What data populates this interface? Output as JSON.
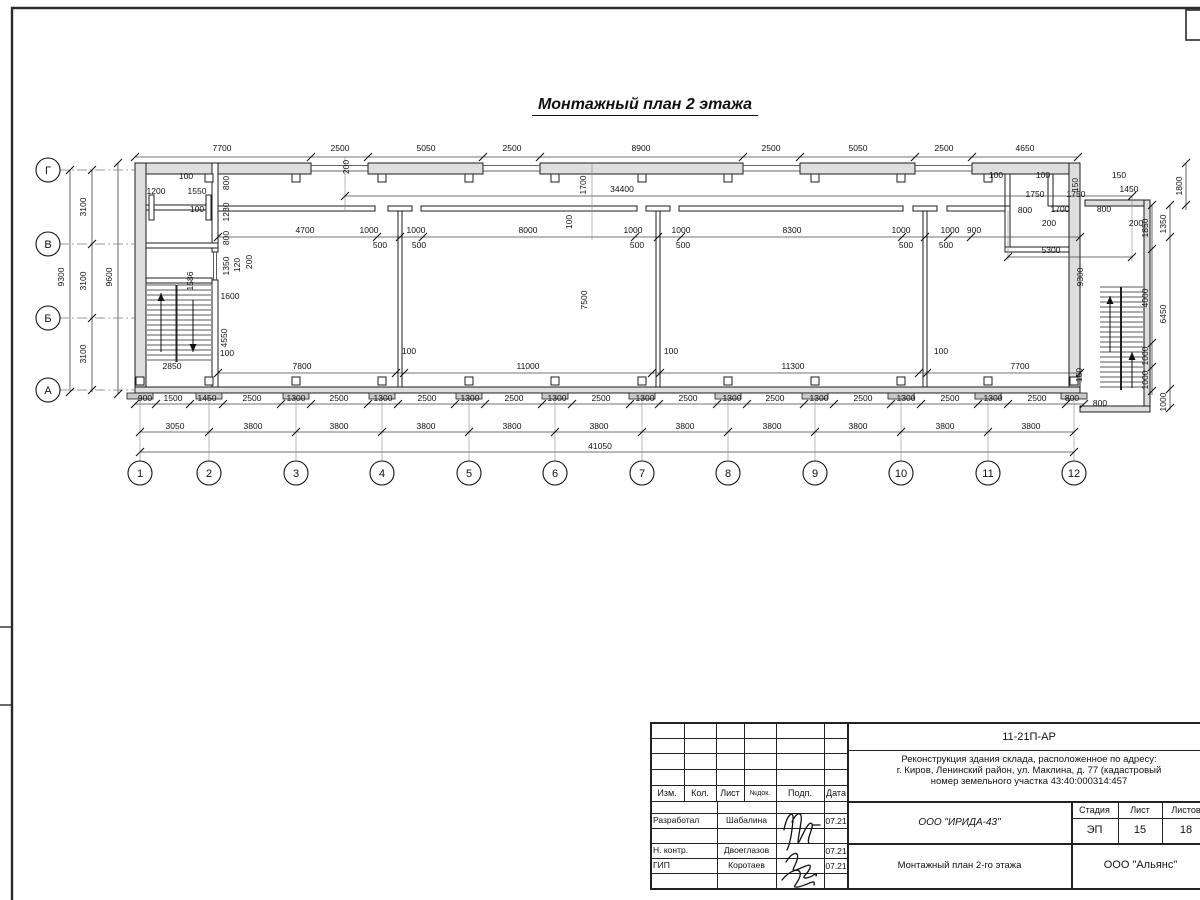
{
  "sheet": {
    "title": "Монтажный план 2 этажа"
  },
  "axes": {
    "rows": [
      {
        "label": "Г",
        "y": 170
      },
      {
        "label": "В",
        "y": 244
      },
      {
        "label": "Б",
        "y": 318
      },
      {
        "label": "А",
        "y": 390
      }
    ],
    "cols": [
      {
        "label": "1",
        "x": 140
      },
      {
        "label": "2",
        "x": 209
      },
      {
        "label": "3",
        "x": 296
      },
      {
        "label": "4",
        "x": 382
      },
      {
        "label": "5",
        "x": 469
      },
      {
        "label": "6",
        "x": 555
      },
      {
        "label": "7",
        "x": 642
      },
      {
        "label": "8",
        "x": 728
      },
      {
        "label": "9",
        "x": 815
      },
      {
        "label": "10",
        "x": 901
      },
      {
        "label": "11",
        "x": 988
      },
      {
        "label": "12",
        "x": 1074
      }
    ]
  },
  "dim_labels": [
    [
      "7700",
      222,
      151
    ],
    [
      "2500",
      340,
      151
    ],
    [
      "5050",
      426,
      151
    ],
    [
      "2500",
      512,
      151
    ],
    [
      "8900",
      641,
      151
    ],
    [
      "2500",
      771,
      151
    ],
    [
      "5050",
      858,
      151
    ],
    [
      "2500",
      944,
      151
    ],
    [
      "4650",
      1025,
      151
    ],
    [
      "200",
      349,
      167,
      1
    ],
    [
      "34400",
      622,
      192
    ],
    [
      "1700",
      586,
      185,
      1
    ],
    [
      "100",
      572,
      222,
      1
    ],
    [
      "9300",
      64,
      277,
      1
    ],
    [
      "3100",
      86,
      207,
      1
    ],
    [
      "3100",
      86,
      281,
      1
    ],
    [
      "3100",
      86,
      354,
      1
    ],
    [
      "9600",
      112,
      277,
      1
    ],
    [
      "100",
      186,
      179
    ],
    [
      "1200",
      156,
      194
    ],
    [
      "1550",
      197,
      194
    ],
    [
      "100",
      197,
      212
    ],
    [
      "800",
      229,
      183,
      1
    ],
    [
      "1280",
      229,
      212,
      1
    ],
    [
      "800",
      229,
      238,
      1
    ],
    [
      "1350",
      229,
      266,
      1
    ],
    [
      "120",
      240,
      265,
      1
    ],
    [
      "200",
      252,
      262,
      1
    ],
    [
      "1586",
      193,
      281,
      1
    ],
    [
      "1600",
      230,
      299
    ],
    [
      "4550",
      227,
      338,
      1
    ],
    [
      "100",
      227,
      356
    ],
    [
      "2850",
      172,
      369
    ],
    [
      "4700",
      305,
      233
    ],
    [
      "1000",
      369,
      233
    ],
    [
      "1000",
      416,
      233
    ],
    [
      "500",
      380,
      248
    ],
    [
      "500",
      419,
      248
    ],
    [
      "8000",
      528,
      233
    ],
    [
      "1000",
      633,
      233
    ],
    [
      "1000",
      681,
      233
    ],
    [
      "500",
      637,
      248
    ],
    [
      "500",
      683,
      248
    ],
    [
      "8300",
      792,
      233
    ],
    [
      "1000",
      901,
      233
    ],
    [
      "1000",
      950,
      233
    ],
    [
      "900",
      974,
      233
    ],
    [
      "500",
      906,
      248
    ],
    [
      "500",
      946,
      248
    ],
    [
      "7500",
      587,
      300,
      1
    ],
    [
      "7800",
      302,
      369
    ],
    [
      "100",
      409,
      354
    ],
    [
      "11000",
      528,
      369
    ],
    [
      "100",
      671,
      354
    ],
    [
      "11300",
      793,
      369
    ],
    [
      "100",
      941,
      354
    ],
    [
      "7700",
      1020,
      369
    ],
    [
      "150",
      1082,
      375,
      1
    ],
    [
      "9300",
      1083,
      277,
      1
    ],
    [
      "5300",
      1051,
      253
    ],
    [
      "100",
      996,
      178
    ],
    [
      "100",
      1043,
      178
    ],
    [
      "150",
      1078,
      185,
      1
    ],
    [
      "150",
      1119,
      178
    ],
    [
      "1450",
      1129,
      192
    ],
    [
      "1750",
      1035,
      197
    ],
    [
      "1750",
      1076,
      197
    ],
    [
      "800",
      1025,
      213
    ],
    [
      "1700",
      1060,
      212
    ],
    [
      "800",
      1104,
      212
    ],
    [
      "200",
      1049,
      226
    ],
    [
      "200",
      1136,
      226
    ],
    [
      "1800",
      1182,
      186,
      1
    ],
    [
      "1850",
      1148,
      228,
      1
    ],
    [
      "1350",
      1166,
      224,
      1
    ],
    [
      "4000",
      1148,
      298,
      1
    ],
    [
      "6450",
      1166,
      314,
      1
    ],
    [
      "1000",
      1148,
      356,
      1
    ],
    [
      "1000",
      1148,
      380,
      1
    ],
    [
      "1000",
      1166,
      402,
      1
    ],
    [
      "800",
      1100,
      406
    ],
    [
      "900",
      145,
      401
    ],
    [
      "1500",
      173,
      401
    ],
    [
      "1450",
      207,
      401
    ],
    [
      "2500",
      252,
      401
    ],
    [
      "1300",
      296,
      401
    ],
    [
      "2500",
      339,
      401
    ],
    [
      "1300",
      383,
      401
    ],
    [
      "2500",
      427,
      401
    ],
    [
      "1300",
      470,
      401
    ],
    [
      "2500",
      514,
      401
    ],
    [
      "1300",
      557,
      401
    ],
    [
      "2500",
      601,
      401
    ],
    [
      "1300",
      645,
      401
    ],
    [
      "2500",
      688,
      401
    ],
    [
      "1300",
      732,
      401
    ],
    [
      "2500",
      775,
      401
    ],
    [
      "1300",
      819,
      401
    ],
    [
      "2500",
      863,
      401
    ],
    [
      "1300",
      906,
      401
    ],
    [
      "2500",
      950,
      401
    ],
    [
      "1300",
      993,
      401
    ],
    [
      "2500",
      1037,
      401
    ],
    [
      "800",
      1072,
      401
    ],
    [
      "3050",
      175,
      429
    ],
    [
      "3800",
      253,
      429
    ],
    [
      "3800",
      339,
      429
    ],
    [
      "3800",
      426,
      429
    ],
    [
      "3800",
      512,
      429
    ],
    [
      "3800",
      599,
      429
    ],
    [
      "3800",
      685,
      429
    ],
    [
      "3800",
      772,
      429
    ],
    [
      "3800",
      858,
      429
    ],
    [
      "3800",
      945,
      429
    ],
    [
      "3800",
      1031,
      429
    ],
    [
      "41050",
      600,
      449
    ]
  ],
  "titleblock": {
    "doc_number": "11-21П-АР",
    "description_lines": [
      "Реконструкция здания склада, расположенное по адресу:",
      "г. Киров, Ленинский район, ул. Маклина, д. 77 (кадастровый",
      "номер земельного участка 43:40:000314:457"
    ],
    "columns": {
      "izm": "Изм.",
      "kol": "Кол.",
      "list": "Лист",
      "ndok": "№док.",
      "podp": "Подп.",
      "data": "Дата"
    },
    "stage_label": "Стадия",
    "sheet_label": "Лист",
    "sheets_label": "Листов",
    "stage": "ЭП",
    "sheet_no": "15",
    "sheets_total": "18",
    "rows": [
      {
        "role": "Разработал",
        "name": "Шабалина",
        "date": "07.21"
      },
      {
        "role": "Н. контр.",
        "name": "Двоеглазов",
        "date": "07.21"
      },
      {
        "role": "ГИП",
        "name": "Коротаев",
        "date": "07.21"
      }
    ],
    "org": "ООО \"ИРИДА-43\"",
    "drawing_title": "Монтажный план 2-го этажа",
    "company": "ООО \"Альянс\""
  }
}
